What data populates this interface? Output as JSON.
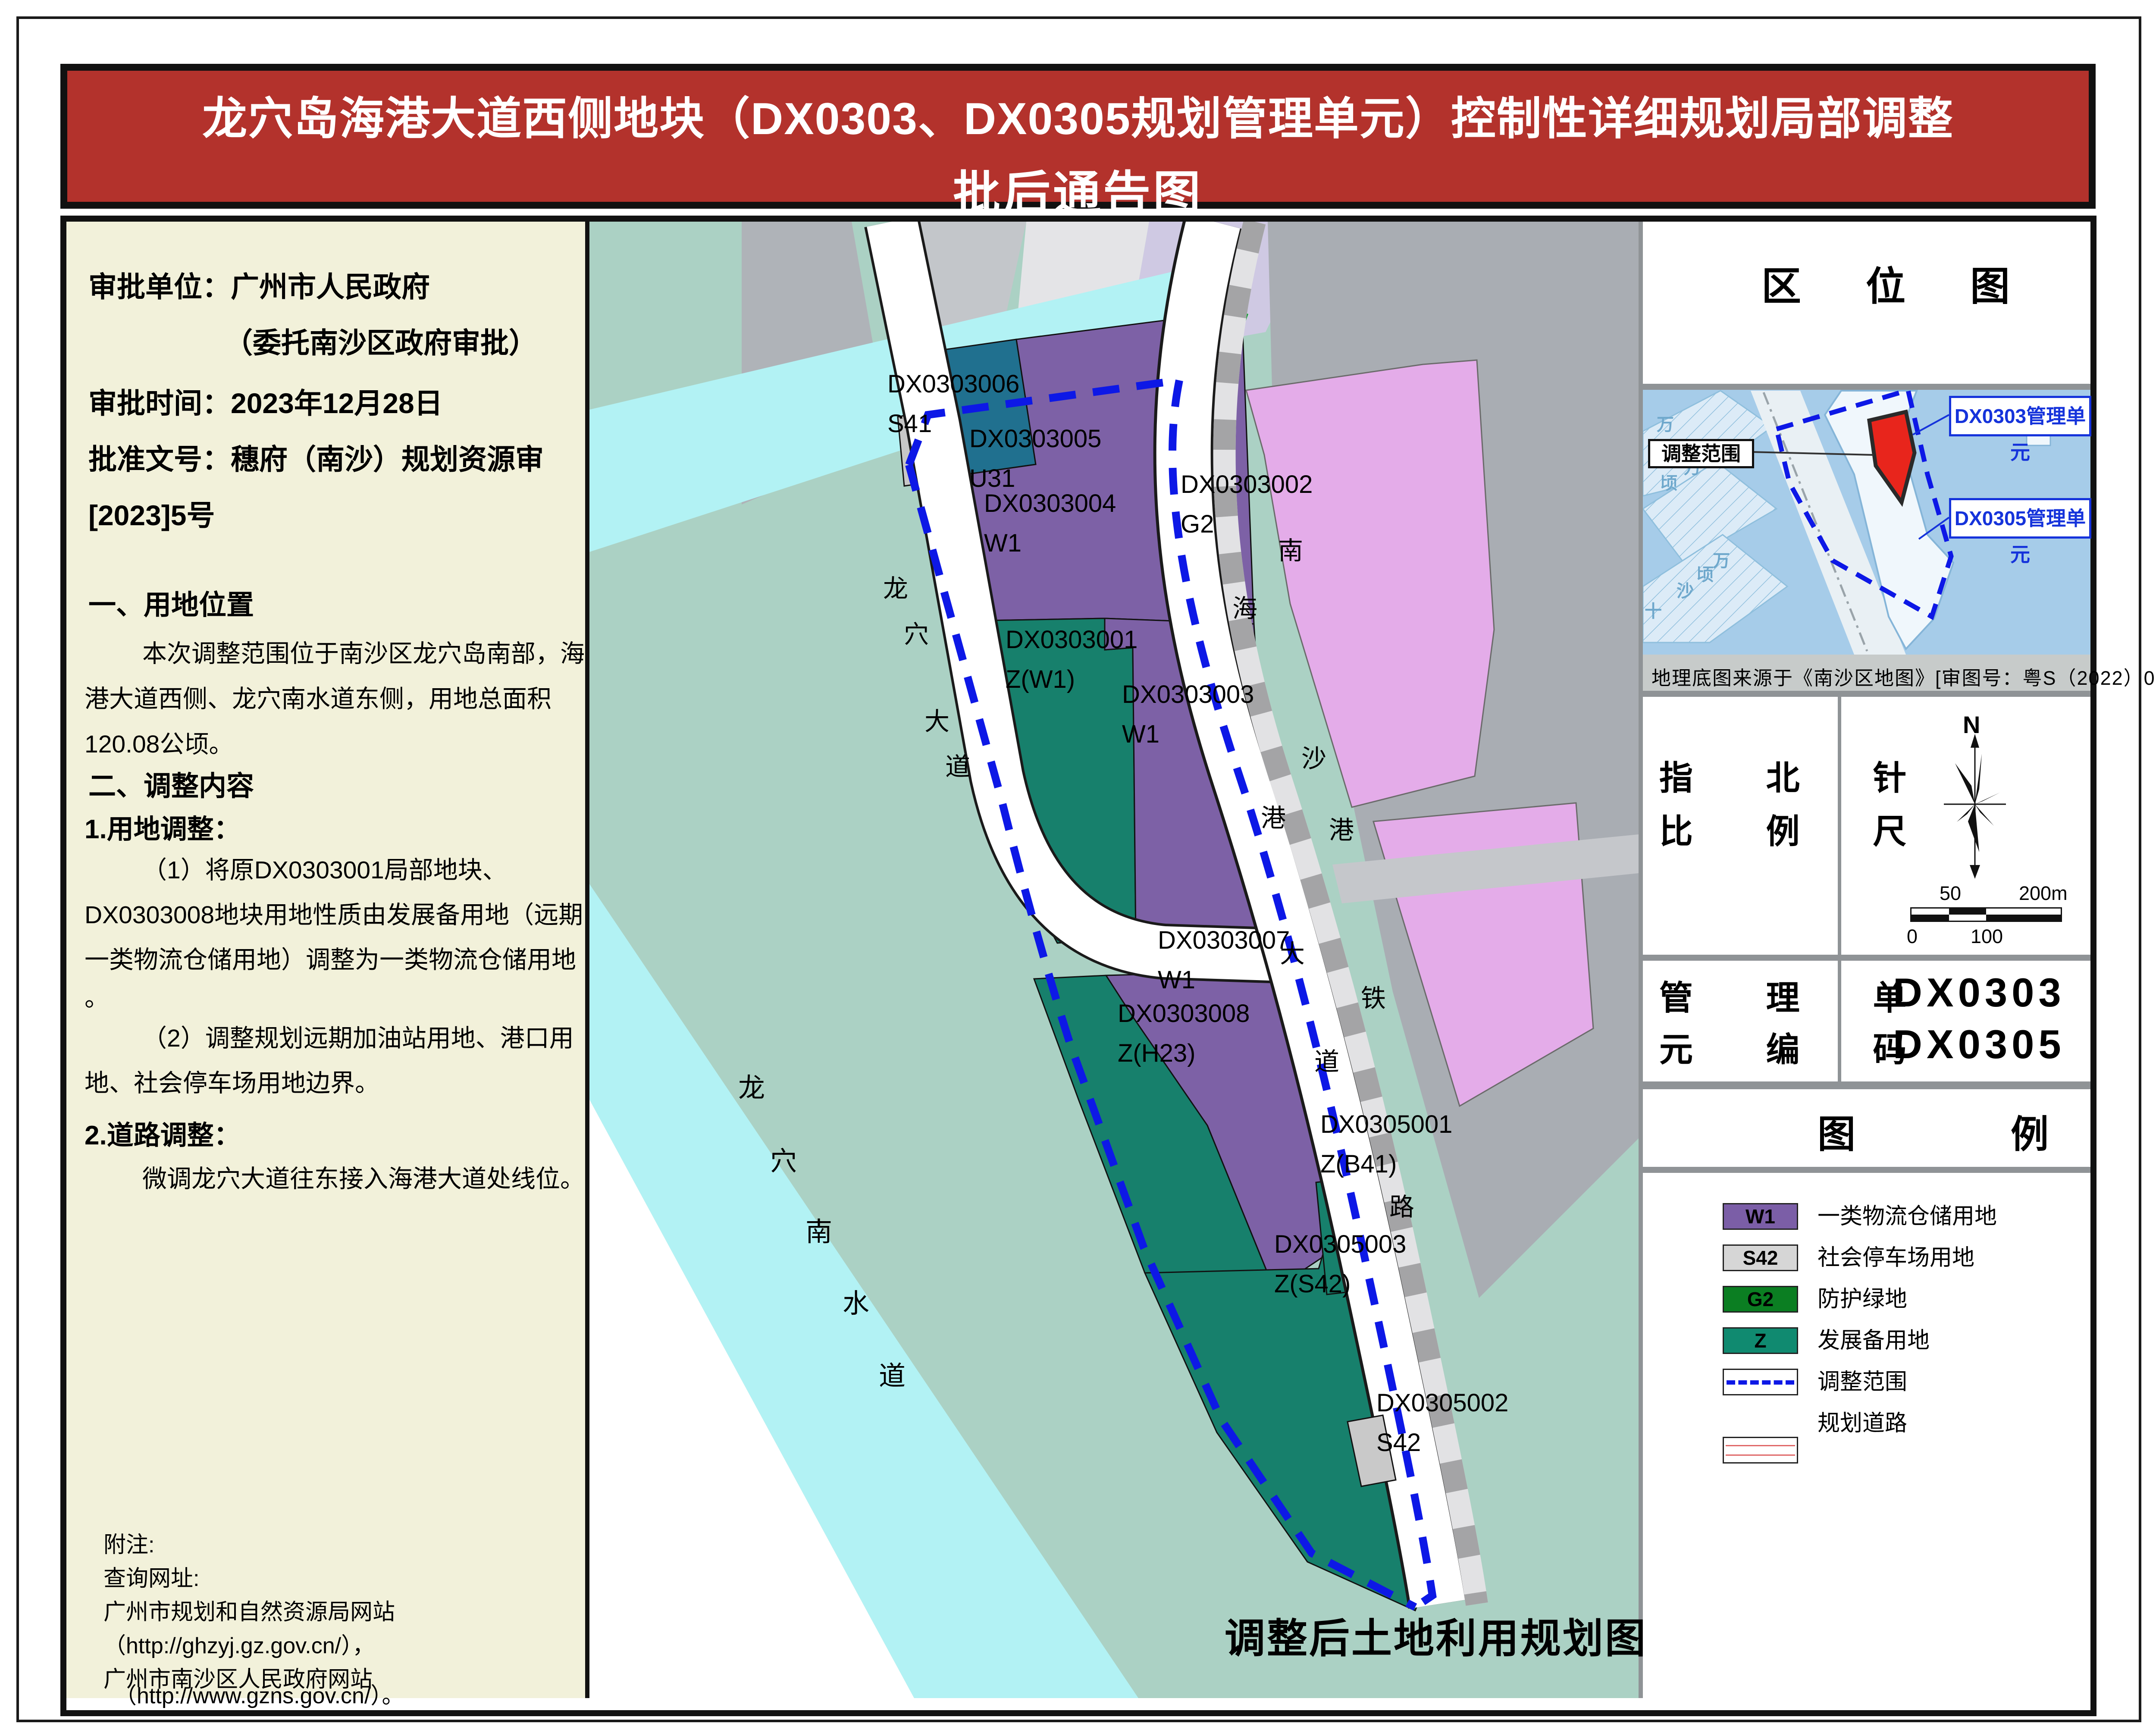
{
  "title": {
    "line1": "龙穴岛海港大道西侧地块（DX0303、DX0305规划管理单元）控制性详细规划局部调整",
    "line2": "批后通告图"
  },
  "info": {
    "approval_unit": "审批单位：广州市人民政府",
    "approval_delegate": "（委托南沙区政府审批）",
    "approval_time": "审批时间：2023年12月28日",
    "doc_no_1": "批准文号：穗府（南沙）规划资源审",
    "doc_no_2": "[2023]5号",
    "sec1_title": "一、用地位置",
    "sec1_l1": "本次调整范围位于南沙区龙穴岛南部，海",
    "sec1_l2": "港大道西侧、龙穴南水道东侧，用地总面积",
    "sec1_l3": "120.08公顷。",
    "sec2_title": "二、调整内容",
    "sub1_title": "1.用地调整：",
    "p1_l1": "（1）将原DX0303001局部地块、",
    "p1_l2": "DX0303008地块用地性质由发展备用地（远期",
    "p1_l3": "一类物流仓储用地）调整为一类物流仓储用地",
    "p1_l4": "。",
    "p2_l1": "（2）调整规划远期加油站用地、港口用",
    "p2_l2": "地、社会停车场用地边界。",
    "sub2_title": "2.道路调整：",
    "p3_l1": "微调龙穴大道往东接入海港大道处线位。",
    "notes": [
      "附注:",
      "查询网址:",
      "广州市规划和自然资源局网站",
      "（http://ghzyj.gz.gov.cn/），",
      "广州市南沙区人民政府网站",
      "（http://www.gzns.gov.cn/）。"
    ]
  },
  "map": {
    "caption": "调整后土地利用规划图",
    "parcels": [
      {
        "code": "DX0303006",
        "use": "S41"
      },
      {
        "code": "DX0303005",
        "use": "U31"
      },
      {
        "code": "DX0303004",
        "use": "W1"
      },
      {
        "code": "DX0303002",
        "use": "G2"
      },
      {
        "code": "DX0303001",
        "use": "Z(W1)"
      },
      {
        "code": "DX0303003",
        "use": "W1"
      },
      {
        "code": "DX0303007",
        "use": "W1"
      },
      {
        "code": "DX0303008",
        "use": "Z(H23)"
      },
      {
        "code": "DX0305001",
        "use": "Z(B41)"
      },
      {
        "code": "DX0305003",
        "use": "Z(S42)"
      },
      {
        "code": "DX0305002",
        "use": "S42"
      }
    ],
    "roads": {
      "longxue_dadao": [
        "龙",
        "穴",
        "大",
        "道"
      ],
      "haigang_dadao": [
        "海",
        "港",
        "大",
        "道"
      ],
      "nansha_tielu": [
        "南",
        "沙",
        "港",
        "铁",
        "路"
      ],
      "longxue_nanshuidao": [
        "龙",
        "穴",
        "南",
        "水",
        "道"
      ]
    }
  },
  "panel": {
    "location_title": "区位图",
    "adjust_scope": "调整范围",
    "unit_0303": "DX0303管理单元",
    "unit_0305": "DX0305管理单元",
    "place_chars": [
      "万",
      "顷",
      "万",
      "万",
      "顷",
      "沙",
      "十"
    ],
    "source_note": "地理底图来源于《南沙区地图》[审图号：粤S（2022）012号]",
    "compass_row1": "指 北 针",
    "compass_row2": "比 例 尺",
    "north_label": "N",
    "scale_50": "50",
    "scale_200": "200m",
    "scale_0": "0",
    "scale_100": "100",
    "code_row1": "管 理 单",
    "code_row2": "元 编 码",
    "code_val1": "DX0303",
    "code_val2": "DX0305",
    "legend_title": "图例",
    "legend": [
      {
        "code": "W1",
        "label": "一类物流仓储用地",
        "color": "#7B5EA7"
      },
      {
        "code": "S42",
        "label": "社会停车场用地",
        "color": "#D6D6D6"
      },
      {
        "code": "G2",
        "label": "防护绿地",
        "color": "#0B7E22"
      },
      {
        "code": "Z",
        "label": "发展备用地",
        "color": "#108A70"
      },
      {
        "code": "",
        "label": "调整范围",
        "color": "#0D18E6"
      },
      {
        "code": "",
        "label": "规划道路",
        "color": "#E06868"
      }
    ]
  },
  "colors": {
    "banner_red": "#B3322C",
    "info_bg": "#F2F1DA",
    "seafoam": "#ABD1C4",
    "cyan_water": "#B2F2F4",
    "purple_w1": "#7D61A6",
    "teal_z": "#17806C",
    "green_g2": "#0FA02C",
    "cyan_u31": "#20708F",
    "pink_port": "#E4ACE9",
    "lavender": "#CFC9E3",
    "gray_urban": "#A9ADB3",
    "boundary_blue": "#0D18E6",
    "loc_water": "#A6CCE9",
    "loc_red": "#E8251C"
  }
}
